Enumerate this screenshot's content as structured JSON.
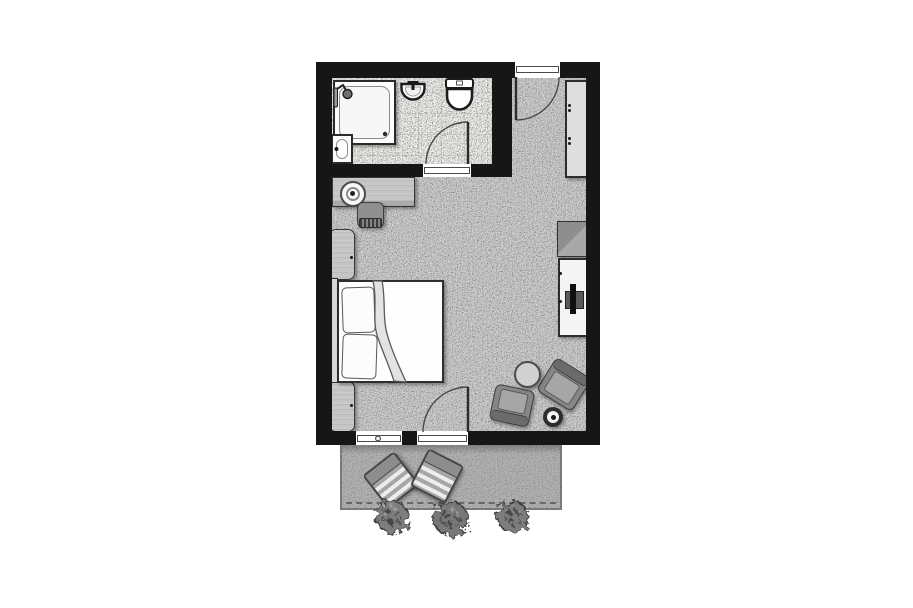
{
  "document": {
    "kind": "architectural-floor-plan",
    "style": "grayscale top-down hotel guest room plan",
    "visible_text": "none"
  },
  "palette": {
    "background": "#ffffff",
    "walls": "#161616",
    "carpet": "#c9c9c9",
    "bathroom_tile": "#f2f1ee",
    "terrace_paving": "#b4b4b4",
    "furniture_light": "#f4f4f4",
    "furniture_gray": "#868686",
    "wood_light": "#c5c5c5",
    "outline": "#2e2e2e"
  },
  "labels": {
    "plan": "guest-room-floor-plan",
    "bathroom": "bathroom",
    "bedroom": "bedroom-living-area",
    "entry": "entry-corridor",
    "terrace": "terrace",
    "shower": "shower-enclosure",
    "vanity": "vanity-sink",
    "washbasin": "wall-hung-washbasin",
    "toilet": "toilet",
    "bath_door": "bathroom-door",
    "entry_door": "entrance-door",
    "terrace_door": "terrace-door",
    "window": "window",
    "wardrobe": "wardrobe-closet",
    "minibar": "minibar-cabinet",
    "tv_sideboard": "tv-sideboard",
    "tv": "television",
    "desk": "desk",
    "desk_lamp": "desk-lamp",
    "desk_chair": "desk-chair",
    "nightstand_top": "nightstand",
    "nightstand_bottom": "nightstand",
    "bed": "double-bed",
    "headboard": "headboard",
    "pillow": "pillow",
    "duvet": "folded-duvet",
    "armchair_left": "armchair",
    "armchair_right": "armchair",
    "round_table": "round-side-table",
    "side_disc": "small-side-table",
    "lounge_left": "terrace-lounge-chair",
    "lounge_right": "terrace-lounge-chair",
    "bush": "shrub-planting"
  },
  "rooms": [
    {
      "id": "bathroom",
      "floor": "tile",
      "fixtures": [
        "shower-enclosure",
        "vanity-sink",
        "wall-hung-washbasin",
        "toilet"
      ],
      "openings": [
        "bathroom-door"
      ]
    },
    {
      "id": "bedroom-living-area",
      "floor": "carpet",
      "furniture": [
        "desk",
        "desk-lamp",
        "desk-chair",
        "nightstand",
        "double-bed",
        "nightstand",
        "wardrobe-closet",
        "minibar-cabinet",
        "tv-sideboard",
        "television",
        "armchair",
        "armchair",
        "round-side-table",
        "small-side-table"
      ],
      "openings": [
        "entrance-door",
        "terrace-door",
        "window"
      ]
    },
    {
      "id": "terrace",
      "floor": "paving",
      "furniture": [
        "terrace-lounge-chair",
        "terrace-lounge-chair"
      ],
      "planting": [
        "shrub",
        "shrub",
        "shrub"
      ]
    }
  ]
}
